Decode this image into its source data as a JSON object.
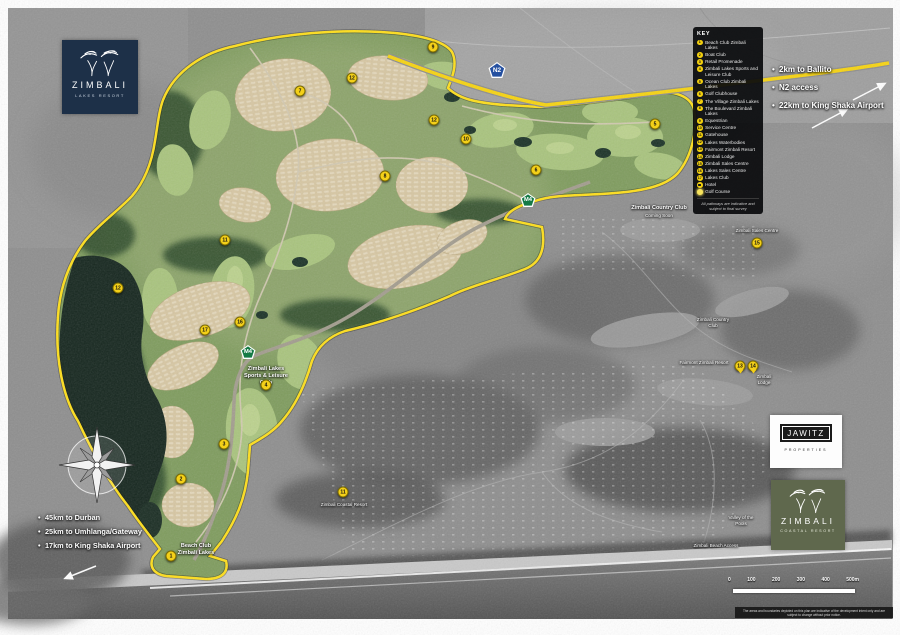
{
  "colors": {
    "accent_yellow": "#f4d019",
    "n2_blue": "#2550a0",
    "m4_green": "#157a45",
    "lakes_navy": "#1d3048",
    "coastal_olive": "#5f684d",
    "key_bg": "#0a0b0d"
  },
  "logos": {
    "lakes": {
      "name": "ZIMBALI",
      "tagline": "LAKES RESORT"
    },
    "jawitz": {
      "name": "JAWITZ",
      "tagline": "PROPERTIES"
    },
    "coastal": {
      "name": "ZIMBALI",
      "tagline": "COASTAL RESORT"
    }
  },
  "key": {
    "title": "KEY",
    "items": [
      {
        "n": "1",
        "label": "Beach Club Zimbali Lakes"
      },
      {
        "n": "2",
        "label": "Boat Club"
      },
      {
        "n": "3",
        "label": "Retail Promenade"
      },
      {
        "n": "4",
        "label": "Zimbali Lakes Sports and Leisure Club"
      },
      {
        "n": "5",
        "label": "Ocean Club Zimbali Lakes"
      },
      {
        "n": "6",
        "label": "Golf Clubhouse"
      },
      {
        "n": "7",
        "label": "The Village Zimbali Lakes"
      },
      {
        "n": "8",
        "label": "The Boulevard Zimbali Lakes"
      },
      {
        "n": "9",
        "label": "Equestrian"
      },
      {
        "n": "10",
        "label": "Service Centre"
      },
      {
        "n": "11",
        "label": "Gatehouse"
      },
      {
        "n": "12",
        "label": "Lakes Waterbodies"
      },
      {
        "n": "13",
        "label": "Fairmont Zimbali Resort"
      },
      {
        "n": "14",
        "label": "Zimbali Lodge"
      },
      {
        "n": "15",
        "label": "Zimbali Sales Centre"
      },
      {
        "n": "16",
        "label": "Lakes Sales Centre"
      },
      {
        "n": "17",
        "label": "Lakes Club"
      }
    ],
    "hotel": {
      "label": "Hotel"
    },
    "golf": {
      "label": "Golf Course"
    },
    "footnote": "All pathways are indicative and subject to final survey"
  },
  "annotations": {
    "north_east": [
      "2km to Ballito",
      "N2 access",
      "22km to King Shaka Airport"
    ],
    "south_west": [
      "45km to Durban",
      "25km to Umhlanga/Gateway",
      "17km to King Shaka Airport"
    ]
  },
  "map_labels": {
    "n2": "N2",
    "m4": "M4",
    "sports": "Zimbali Lakes Sports & Leisure Club",
    "beach_club": "Beach Club Zimbali Lakes",
    "country_coming": "Zimbali Country Club",
    "country_coming_sub": "Coming Soon",
    "sales_centre": "Zimbali Sales Centre",
    "country_club": "Zimbali Country Club",
    "fairmont": "Fairmont Zimbali Resort",
    "lodge": "Zimbali Lodge",
    "valley": "Valley of the Pools",
    "beach_access": "Zimbali Beach Access",
    "coastal_resort": "Zimbali Coastal Resort"
  },
  "markers": [
    {
      "n": "1",
      "x": 171,
      "y": 556
    },
    {
      "n": "2",
      "x": 181,
      "y": 479
    },
    {
      "n": "3",
      "x": 224,
      "y": 444
    },
    {
      "n": "4",
      "x": 266,
      "y": 385
    },
    {
      "n": "5",
      "x": 655,
      "y": 124
    },
    {
      "n": "6",
      "x": 536,
      "y": 170
    },
    {
      "n": "7",
      "x": 300,
      "y": 91
    },
    {
      "n": "8",
      "x": 385,
      "y": 176
    },
    {
      "n": "9",
      "x": 433,
      "y": 47
    },
    {
      "n": "10",
      "x": 466,
      "y": 139
    },
    {
      "n": "11",
      "x": 343,
      "y": 492
    },
    {
      "n": "11",
      "x": 225,
      "y": 240
    },
    {
      "n": "12",
      "x": 118,
      "y": 288
    },
    {
      "n": "12",
      "x": 352,
      "y": 78
    },
    {
      "n": "12",
      "x": 434,
      "y": 120
    },
    {
      "n": "15",
      "x": 757,
      "y": 243
    },
    {
      "n": "16",
      "x": 240,
      "y": 322
    },
    {
      "n": "17",
      "x": 205,
      "y": 330
    },
    {
      "n": "13",
      "x": 740,
      "y": 366
    },
    {
      "n": "14",
      "x": 753,
      "y": 366
    }
  ],
  "scale": {
    "ticks": [
      "0",
      "100",
      "200",
      "300",
      "400",
      "500m"
    ]
  },
  "footer_disclaimer": "The areas and boundaries depicted on this plan are indicative of the development intent only and are subject to change without prior notice."
}
